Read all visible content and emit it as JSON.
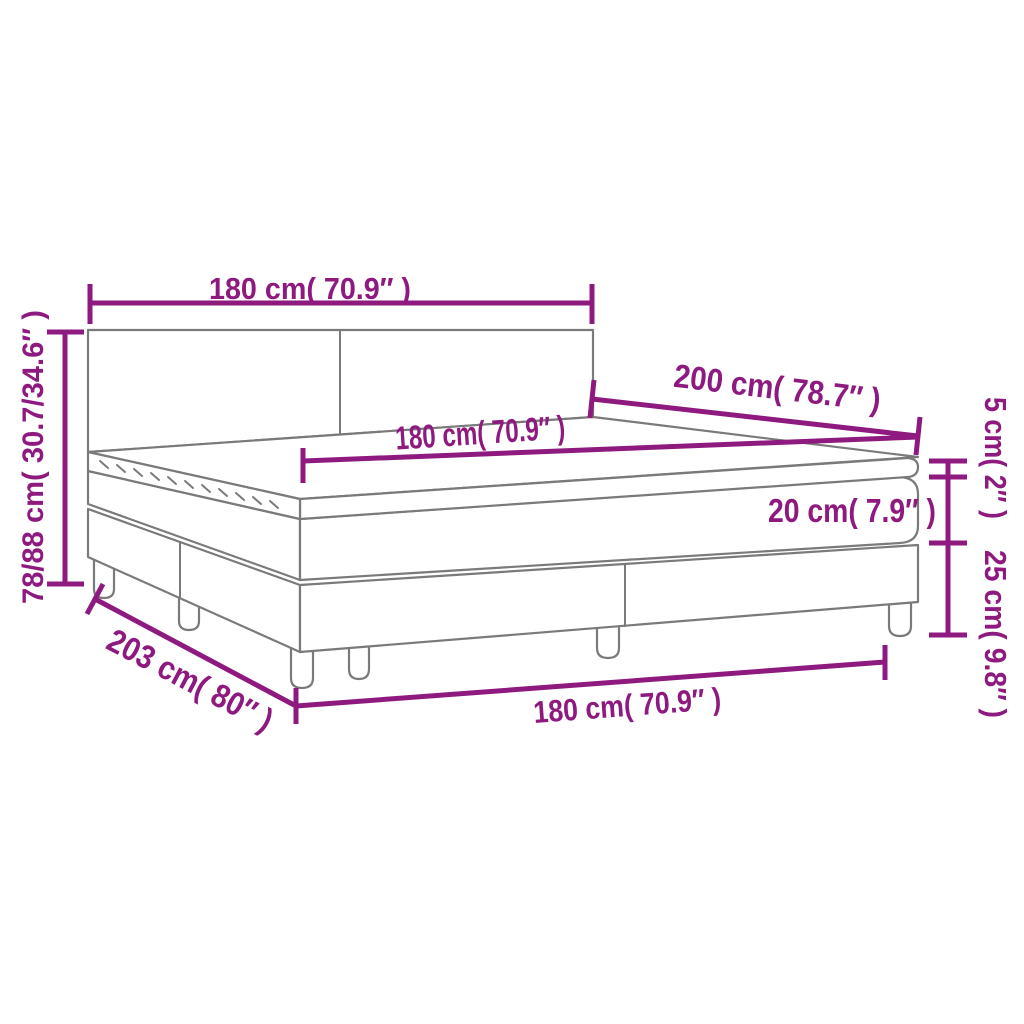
{
  "diagram": {
    "kind": "product-dimension-diagram",
    "subject": "box-spring-bed-with-mattress-and-topper",
    "accent_color": "#8E1A80",
    "drawing_color": "#7A7A7A",
    "background_color": "#FFFFFF"
  },
  "labels": {
    "top_width": "180 cm( 70.9″ )",
    "overall_height": "78/88 cm( 30.7/34.6″ )",
    "length": "200 cm( 78.7″ )",
    "mattress_width": "180 cm( 70.9″ )",
    "topper_height": "5 cm( 2″ )",
    "mattress_height": "20 cm( 7.9″ )",
    "base_height": "25 cm( 9.8″ )",
    "total_length": "203 cm( 80″ )",
    "bottom_width": "180 cm( 70.9″ )"
  },
  "measurements": [
    {
      "id": "top_width",
      "cm": "180",
      "inches": "70.9"
    },
    {
      "id": "overall_height",
      "cm": "78/88",
      "inches": "30.7/34.6"
    },
    {
      "id": "length",
      "cm": "200",
      "inches": "78.7"
    },
    {
      "id": "mattress_width",
      "cm": "180",
      "inches": "70.9"
    },
    {
      "id": "topper_height",
      "cm": "5",
      "inches": "2"
    },
    {
      "id": "mattress_height",
      "cm": "20",
      "inches": "7.9"
    },
    {
      "id": "base_height",
      "cm": "25",
      "inches": "9.8"
    },
    {
      "id": "total_length",
      "cm": "203",
      "inches": "80"
    },
    {
      "id": "bottom_width",
      "cm": "180",
      "inches": "70.9"
    }
  ]
}
